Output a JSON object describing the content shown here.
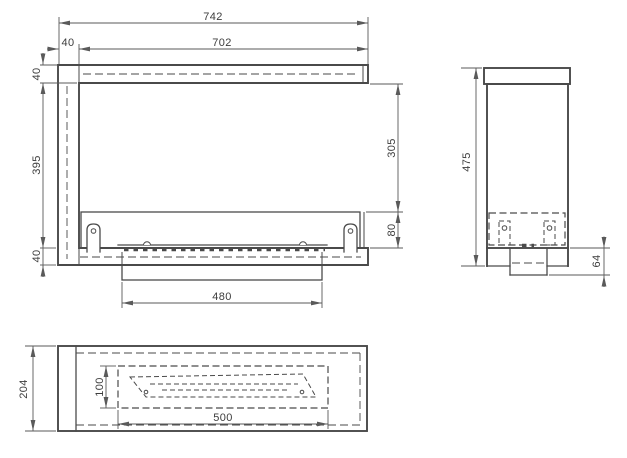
{
  "colors": {
    "background": "#ffffff",
    "line": "#4a4a4a",
    "dim": "#5a5a5a",
    "text": "#3d3d3d"
  },
  "views": {
    "front": {
      "dims": {
        "total_width": "742",
        "inner_width": "702",
        "left_wall_width": "40",
        "top_wall_height": "40",
        "inner_height": "395",
        "bottom_wall_height": "40",
        "opening_height": "305",
        "burner_box_height": "80",
        "tray_width": "480"
      }
    },
    "side": {
      "dims": {
        "total_height": "475",
        "tray_protrusion": "64"
      }
    },
    "bottom": {
      "dims": {
        "body_depth": "204",
        "opening_depth": "100",
        "opening_width": "500"
      }
    }
  }
}
